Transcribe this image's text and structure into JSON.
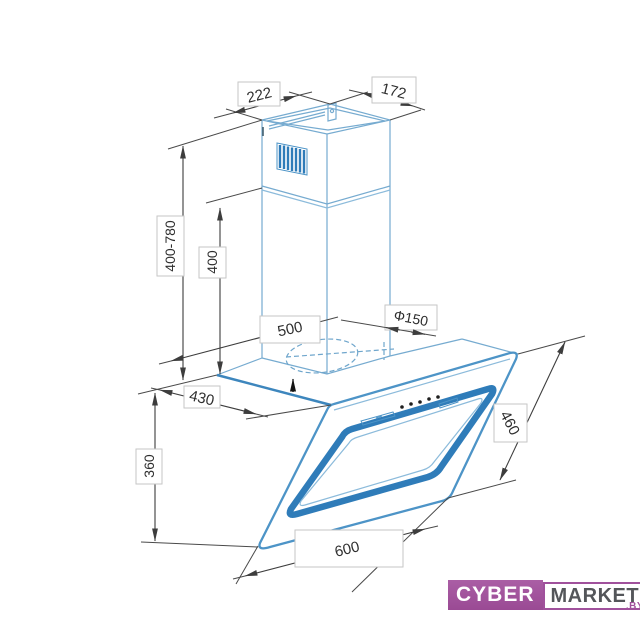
{
  "drawing": {
    "dimensions": {
      "chimney_top_width": "222",
      "chimney_top_depth": "172",
      "telescopic_height_range": "400-780",
      "chimney_section_height": "400",
      "wall_to_front_depth": "500",
      "duct_diameter": "Φ150",
      "body_depth": "430",
      "body_height": "360",
      "glass_length": "460",
      "body_width": "600"
    }
  },
  "watermark": {
    "brand_primary": "CYBER",
    "brand_secondary": "MARKET",
    "domain_suffix": ".BY"
  },
  "colors": {
    "line_blue": "#76ABD0",
    "accent_blue": "#2F7CB9",
    "dimension_gray": "#3D3D3D",
    "brand_purple": "#A0519C"
  }
}
